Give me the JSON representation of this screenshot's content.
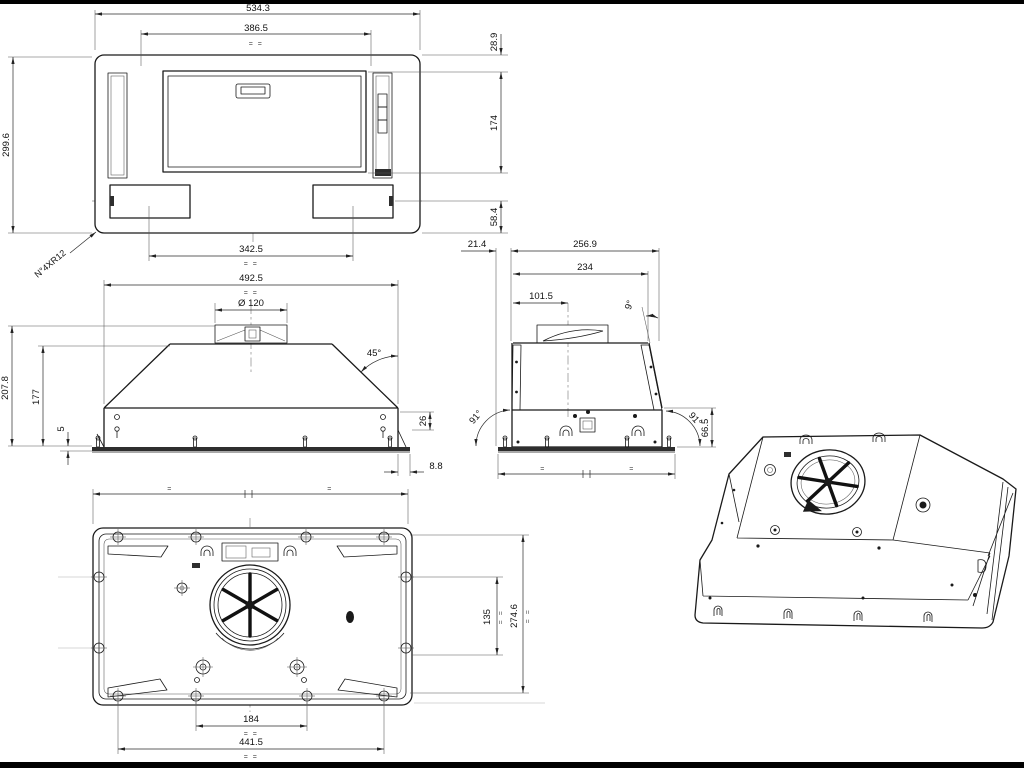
{
  "page": {
    "background": "#000000",
    "paper": "#ffffff",
    "line_color": "#1a1a1a"
  },
  "plan_view": {
    "dim_width_overall": "534.3",
    "dim_width_inner": "386.5",
    "dim_height_overall": "299.6",
    "dim_top_inset": "28.9",
    "dim_panel_height": "174",
    "dim_bracket_to_bottom": "58.4",
    "dim_bracket_spacing": "342.5",
    "note_corner_radii": "N°4XR12",
    "sym_marks": "= ="
  },
  "front_view": {
    "dim_body_width": "492.5",
    "dim_duct_diameter": "Ø 120",
    "dim_slope_angle": "45°",
    "dim_height_overall": "207.8",
    "dim_height_body": "177",
    "dim_flange_thickness": "5",
    "dim_corner_height": "26",
    "dim_flange_overhang": "8.8",
    "sym_marks": "= ="
  },
  "side_view": {
    "dim_flange_inset": "21.4",
    "dim_depth_overall": "256.9",
    "dim_depth_body": "234",
    "dim_duct_center": "101.5",
    "dim_back_tilt": "9°",
    "dim_front_angle": "91°",
    "dim_rear_angle": "91°",
    "dim_lower_height": "66.5",
    "equal_left": "=",
    "equal_right": "="
  },
  "bottom_view": {
    "dim_bracket_spacing": "184",
    "dim_screw_span": "441.5",
    "dim_bracket_vertical": "135",
    "dim_inner_depth": "274.6",
    "sym_marks": "= =",
    "equal_left": "=",
    "equal_right": "="
  }
}
